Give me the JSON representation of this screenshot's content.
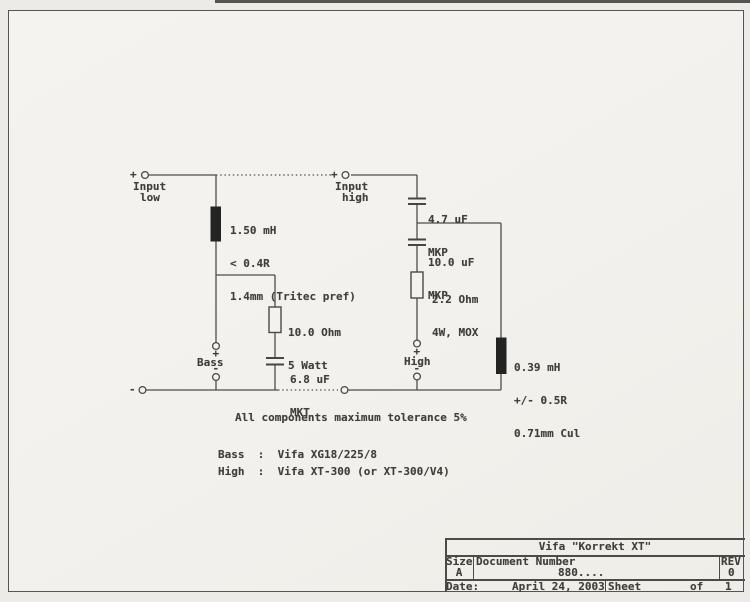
{
  "page": {
    "paper_color": "#f4f2ee",
    "ink_color": "#4b4b49"
  },
  "terminals": {
    "input_low": {
      "sign": "+",
      "line1": "Input",
      "line2": "low"
    },
    "input_high": {
      "sign": "+",
      "line1": "Input",
      "line2": "high"
    },
    "bass": {
      "plus": "+",
      "label": "Bass",
      "minus": "-"
    },
    "high": {
      "plus": "+",
      "label": "High",
      "minus": "-"
    },
    "neg_return": {
      "sign": "-"
    }
  },
  "components": {
    "inductor_bass": {
      "lines": [
        "1.50 mH",
        "< 0.4R",
        "1.4mm (Tritec pref)"
      ]
    },
    "cap_4_7uf": {
      "lines": [
        "4.7 uF",
        "MKP"
      ]
    },
    "cap_10uf": {
      "lines": [
        "10.0 uF",
        "MKP"
      ]
    },
    "res_2_2ohm": {
      "lines": [
        "2.2 Ohm",
        "4W, MOX"
      ]
    },
    "res_10ohm": {
      "lines": [
        "10.0 Ohm",
        "5 Watt"
      ]
    },
    "cap_6_8uf": {
      "lines": [
        "6.8 uF",
        "MKT"
      ]
    },
    "inductor_high": {
      "lines": [
        "0.39 mH",
        "+/- 0.5R",
        "0.71mm Cul"
      ]
    }
  },
  "notes": {
    "tolerance": "All components maximum tolerance 5%",
    "bass_driver": "Bass  :  Vifa XG18/225/8",
    "high_driver": "High  :  Vifa XT-300 (or XT-300/V4)"
  },
  "title_block": {
    "title": "Vifa \"Korrekt XT\"",
    "size_label": "Size",
    "size_value": "A",
    "document_label": "Document Number",
    "document_value": "880....",
    "rev_label": "REV",
    "rev_value": "0",
    "date_label": "Date:",
    "date_value": "April 24, 2003",
    "sheet_label": "Sheet",
    "of_label": "of",
    "sheet_total": "1"
  }
}
